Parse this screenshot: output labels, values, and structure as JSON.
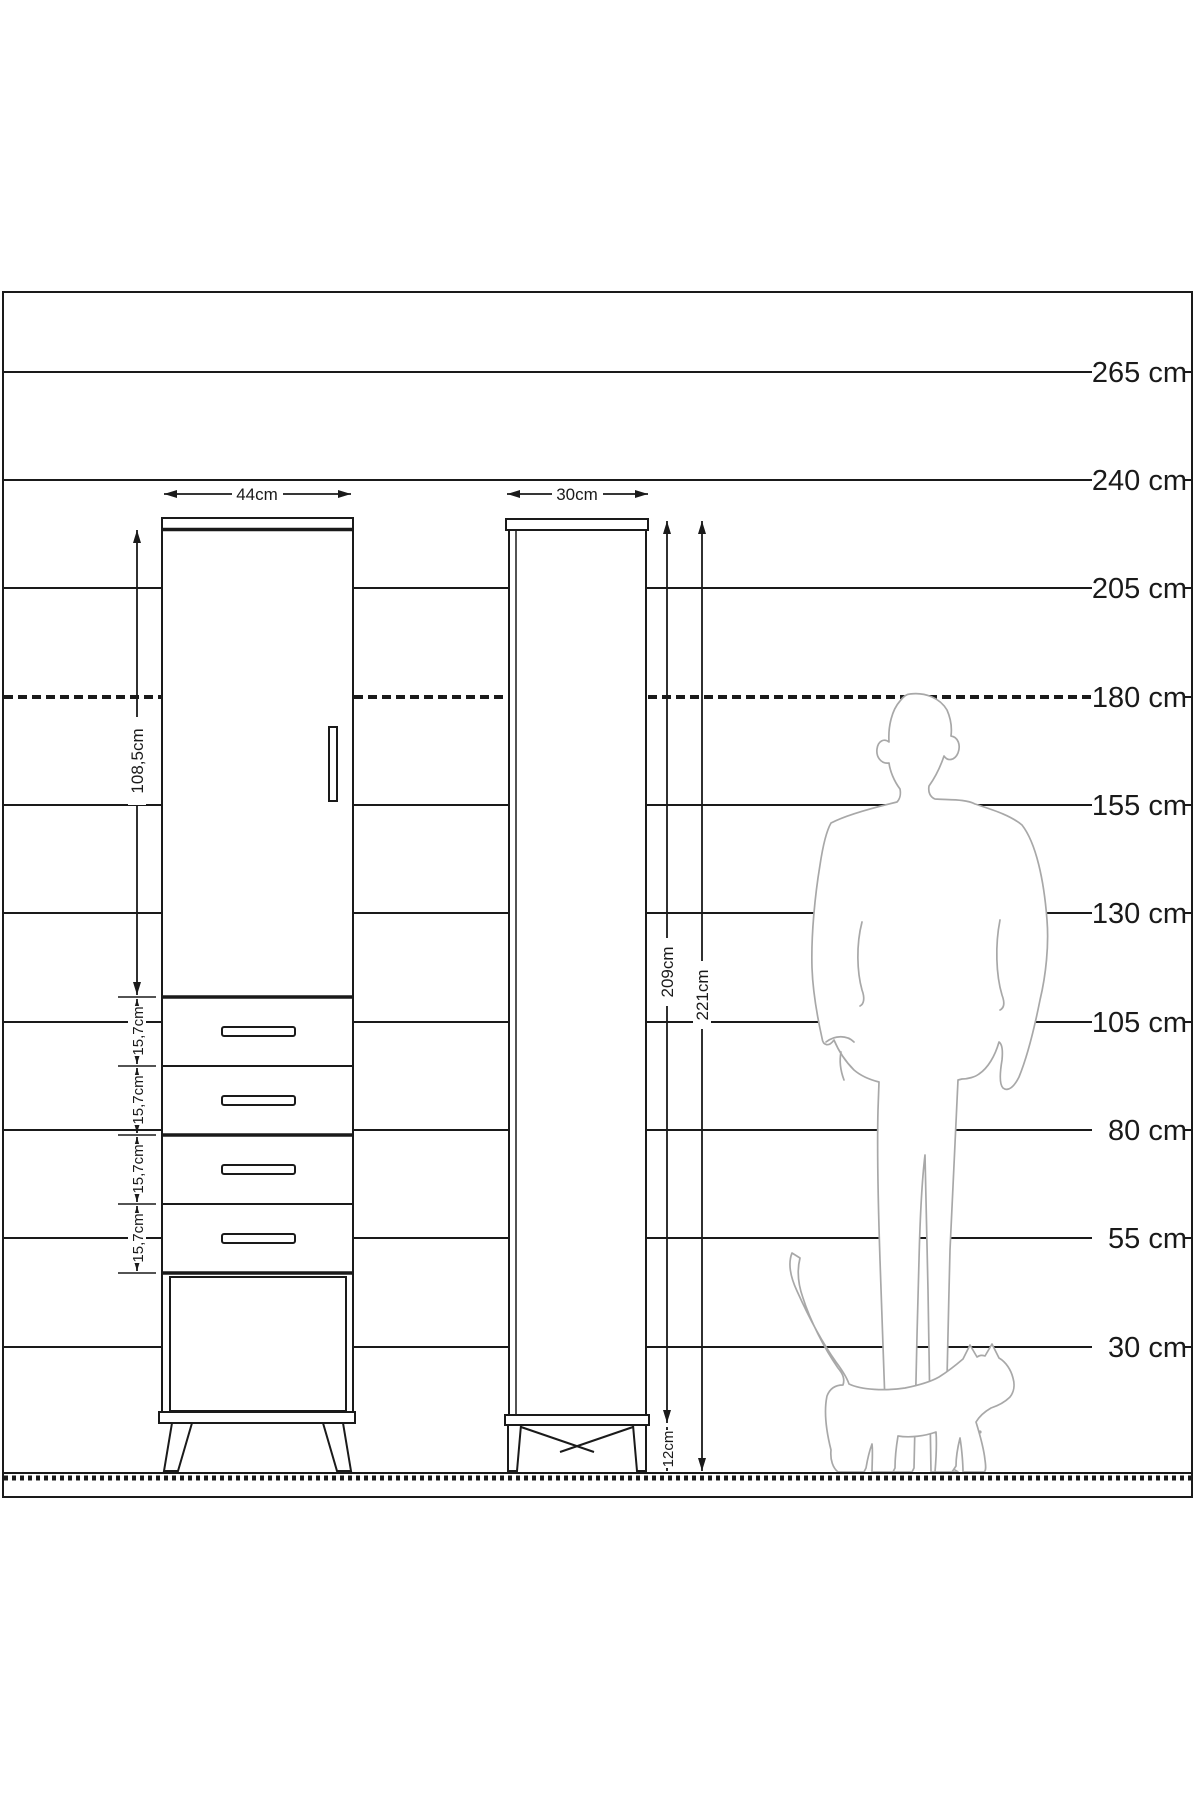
{
  "scale": {
    "labels": [
      "265 cm",
      "240 cm",
      "205 cm",
      "180 cm",
      "155 cm",
      "130 cm",
      "105 cm",
      "80 cm",
      "55 cm",
      "30 cm"
    ]
  },
  "front_view": {
    "width": "44cm",
    "door_height": "108,5cm",
    "drawer_heights": [
      "15,7cm",
      "15,7cm",
      "15,7cm",
      "15,7cm"
    ]
  },
  "side_view": {
    "depth": "30cm",
    "carcass_height": "209cm",
    "total_height": "221cm",
    "leg_height": "12cm"
  },
  "colors": {
    "line": "#1a1a1a",
    "silhouette": "#a8a8a8",
    "background": "#ffffff"
  }
}
